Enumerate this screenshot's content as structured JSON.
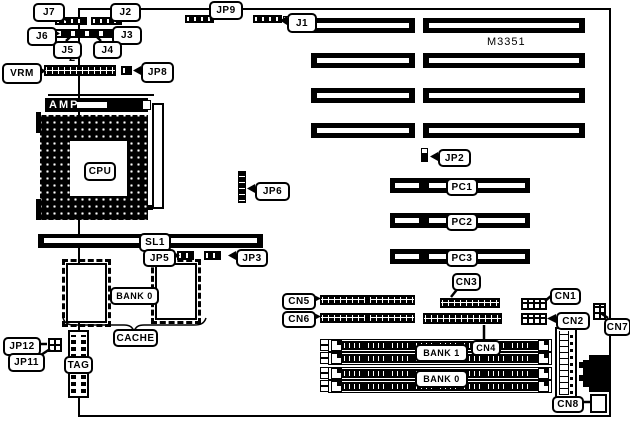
{
  "board": {
    "chipset_label": "M3351"
  },
  "labels": {
    "j7": "J7",
    "j2": "J2",
    "jp9": "JP9",
    "j1": "J1",
    "j6": "J6",
    "j5": "J5",
    "j4": "J4",
    "j3": "J3",
    "vrm": "VRM",
    "jp8": "JP8",
    "pin2": "2",
    "amp": "AMP",
    "cpu": "CPU",
    "jp2": "JP2",
    "jp6": "JP6",
    "pc1": "PC1",
    "pc2": "PC2",
    "pc3": "PC3",
    "sl1": "SL1",
    "jp5": "JP5",
    "jp3": "JP3",
    "bank0_cache": "BANK 0",
    "cache": "CACHE",
    "jp12": "JP12",
    "jp11": "JP11",
    "tag": "TAG",
    "cn5": "CN5",
    "cn6": "CN6",
    "cn3": "CN3",
    "cn4": "CN4",
    "cn1": "CN1",
    "cn2": "CN2",
    "cn7": "CN7",
    "cn8": "CN8",
    "bank1_simm": "BANK 1",
    "bank0_simm": "BANK 0"
  }
}
